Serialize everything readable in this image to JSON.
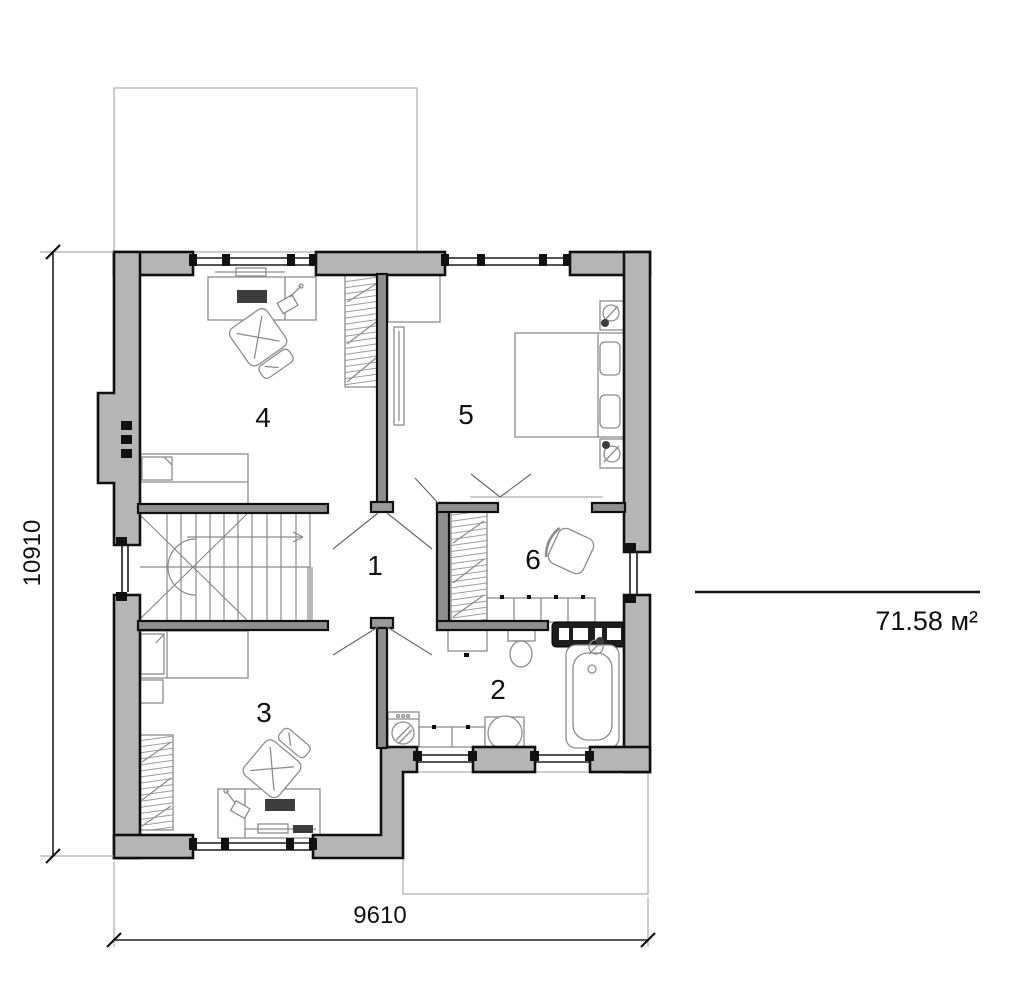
{
  "rooms": [
    {
      "id": "hall",
      "label": "1"
    },
    {
      "id": "bathroom",
      "label": "2"
    },
    {
      "id": "bedroom-lower",
      "label": "3"
    },
    {
      "id": "bedroom-upper",
      "label": "4"
    },
    {
      "id": "bedroom-master",
      "label": "5"
    },
    {
      "id": "dressing-room",
      "label": "6"
    }
  ],
  "dimensions": {
    "vertical_mm": "10910",
    "horizontal_mm": "9610"
  },
  "area": {
    "label": "71.58 м²"
  },
  "colors": {
    "wall_fill": "#b5b5b5",
    "wall_outline": "#111111",
    "furniture_line": "#8d8d8d",
    "background": "#ffffff"
  }
}
